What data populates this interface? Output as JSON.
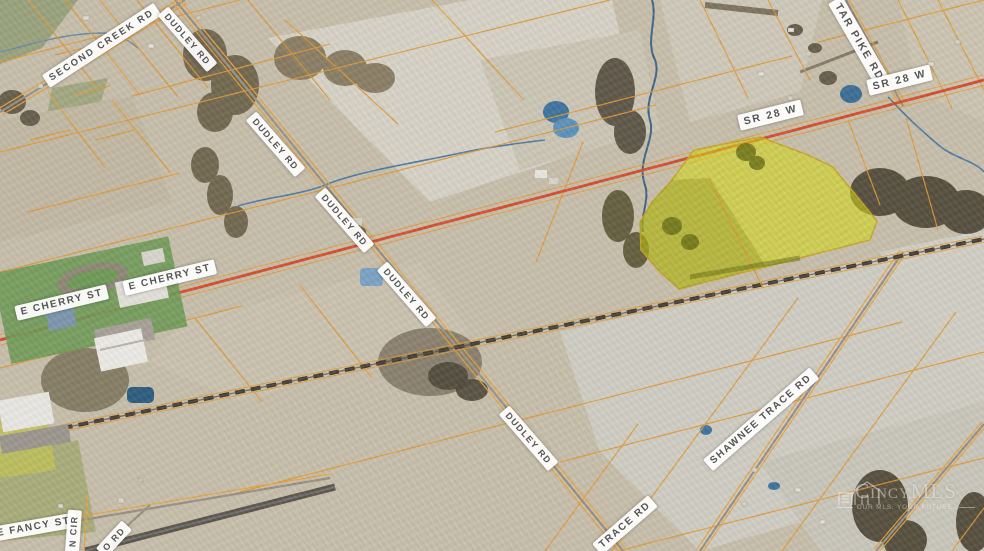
{
  "map": {
    "labels": {
      "second_creek_rd": "SECOND CREEK RD",
      "dudley_rd": "DUDLEY RD",
      "tar_pike_rd": "TAR PIKE RD",
      "sr_28_w": "SR 28 W",
      "e_cherry_st": "E CHERRY ST",
      "shawnee_trace_rd": "SHAWNEE TRACE RD",
      "trace_rd_partial": "TRACE RD",
      "e_fancy_st": "E FANCY ST",
      "n_cir_partial": "N CIR",
      "o_rd_partial": "O RD"
    },
    "watermark": {
      "brand": "CincyMLS",
      "tagline": "OUR MLS. YOUR FUTURE."
    },
    "colors": {
      "parcel_line": "#e19a36",
      "highway_red": "#d94e2c",
      "road_yellow": "#e8a33d",
      "highlight_parcel_yellow": "#d8dc0e",
      "water_blue": "#3f6d98",
      "railroad_dark": "#3f3a32",
      "label_background": "#ffffff",
      "label_text": "#555555",
      "land_base": "#c7bfab"
    }
  }
}
